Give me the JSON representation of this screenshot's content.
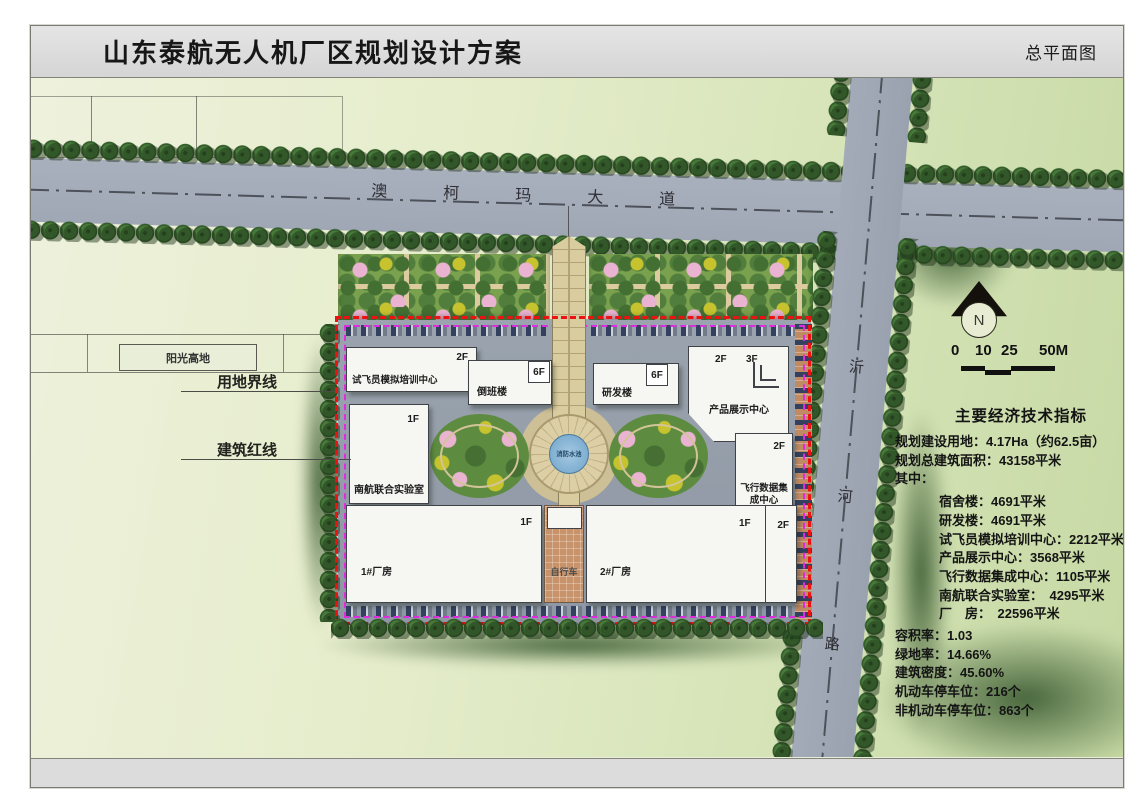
{
  "title_bar": {
    "project_title": "山东泰航无人机厂区规划设计方案",
    "drawing_title": "总平面图"
  },
  "roads": {
    "aokema_avenue": "澳柯玛大道",
    "yihe": {
      "c1": "沂",
      "c2": "河",
      "c3": "路"
    }
  },
  "annotations": {
    "sunshine_highland": "阳光高地",
    "land_use_boundary": "用地界线",
    "building_red_line": "建筑红线"
  },
  "buildings": {
    "pilot_training_center": {
      "name": "试飞员模拟培训中心",
      "floors": "2F"
    },
    "shift_building": {
      "name": "倒班楼",
      "floors": "6F"
    },
    "rd_building": {
      "name": "研发楼",
      "floors": "6F"
    },
    "product_exhibition_center": {
      "name": "产品展示中心",
      "floors_left": "2F",
      "floors_right": "3F"
    },
    "flight_data_center": {
      "name": "飞行数据集成中心",
      "floors": "2F"
    },
    "nuaa_joint_lab": {
      "name": "南航联合实验室",
      "floors": "1F"
    },
    "factory_1": {
      "name": "1#厂房",
      "floors": "1F"
    },
    "bicycle_shed": {
      "name": "自行车"
    },
    "factory_2": {
      "name": "2#厂房",
      "floors": "1F",
      "floors_right": "2F"
    },
    "fire_water_pool": {
      "name": "消防水池"
    }
  },
  "compass": {
    "north_label": "N"
  },
  "scale_bar": {
    "t0": "0",
    "t1": "10",
    "t2": "25",
    "t3": "50M"
  },
  "indicators": {
    "title": "主要经济技术指标",
    "lines": [
      "规划建设用地：4.17Ha（约62.5亩）",
      "规划总建筑面积：43158平米",
      "其中：",
      "宿舍楼：4691平米",
      "研发楼：4691平米",
      "试飞员模拟培训中心：2212平米",
      "产品展示中心：3568平米",
      "飞行数据集成中心：1105平米",
      "南航联合实验室：　4295平米",
      "厂　房：　22596平米",
      "容积率：1.03",
      "绿地率：14.66%",
      "建筑密度：45.60%",
      "机动车停车位：216个",
      "非机动车停车位：863个"
    ]
  },
  "colors": {
    "site_boundary_red": "#ee1111",
    "building_line_magenta": "#df2cdf",
    "road_gray": "#a3aab8",
    "water_blue": "#6ea3c9",
    "field_green": "#e6edcc"
  }
}
